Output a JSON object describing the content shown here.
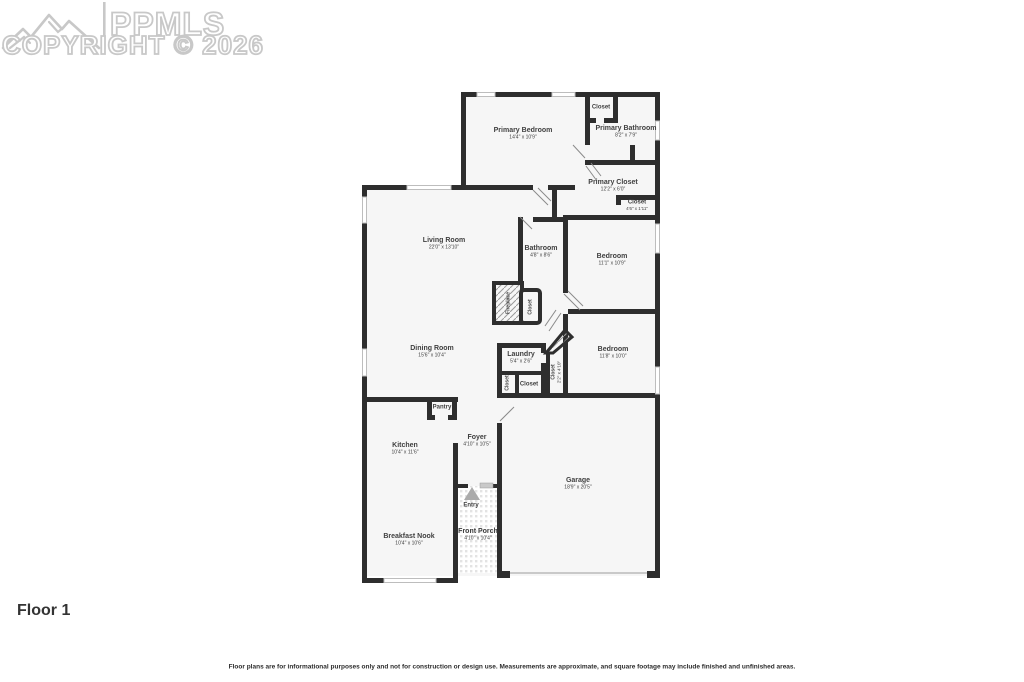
{
  "watermark": {
    "logo": "PPMLS",
    "copyright": "COPYRIGHT © 2026"
  },
  "floor_label": "Floor 1",
  "disclaimer": "Floor plans are for informational purposes only and not for construction or design use. Measurements are approximate, and square footage may include finished and unfinished areas.",
  "rooms": {
    "primary_bedroom": {
      "name": "Primary Bedroom",
      "dims": "14'4\" x 10'9\""
    },
    "primary_closet_top": {
      "name": "Closet"
    },
    "primary_bathroom": {
      "name": "Primary Bathroom",
      "dims": "8'2\" x 7'9\""
    },
    "primary_closet": {
      "name": "Primary Closet",
      "dims": "12'2\" x 6'0\""
    },
    "hall_closet_small": {
      "name": "Closet",
      "dims": "4'6\" x 1'11\""
    },
    "living_room": {
      "name": "Living Room",
      "dims": "22'0\" x 13'10\""
    },
    "bathroom": {
      "name": "Bathroom",
      "dims": "4'8\" x 8'6\""
    },
    "bedroom_upper": {
      "name": "Bedroom",
      "dims": "11'1\" x 10'9\""
    },
    "fireplace": {
      "name": "Fireplace"
    },
    "fireplace_closet": {
      "name": "Closet"
    },
    "dining_room": {
      "name": "Dining Room",
      "dims": "15'6\" x 10'4\""
    },
    "laundry": {
      "name": "Laundry",
      "dims": "5'4\" x 2'6\""
    },
    "laundry_closet_left": {
      "name": "Closet"
    },
    "laundry_closet": {
      "name": "Closet"
    },
    "hall_closet": {
      "name": "Closet",
      "dims": "2'2\" x 4'10\""
    },
    "bedroom_lower": {
      "name": "Bedroom",
      "dims": "11'8\" x 10'0\""
    },
    "pantry": {
      "name": "Pantry"
    },
    "kitchen": {
      "name": "Kitchen",
      "dims": "10'4\" x 11'6\""
    },
    "foyer": {
      "name": "Foyer",
      "dims": "4'10\" x 10'5\""
    },
    "garage": {
      "name": "Garage",
      "dims": "18'9\" x 20'5\""
    },
    "breakfast_nook": {
      "name": "Breakfast Nook",
      "dims": "10'4\" x 10'6\""
    },
    "entry": {
      "name": "Entry"
    },
    "front_porch": {
      "name": "Front Porch",
      "dims": "4'10\" x 10'4\""
    }
  },
  "colors": {
    "wall": "#2e2e2e",
    "room_fill": "#f6f6f6",
    "text": "#3f3f3f",
    "watermark": "#c8c8c8",
    "window": "#bdbdbd"
  }
}
